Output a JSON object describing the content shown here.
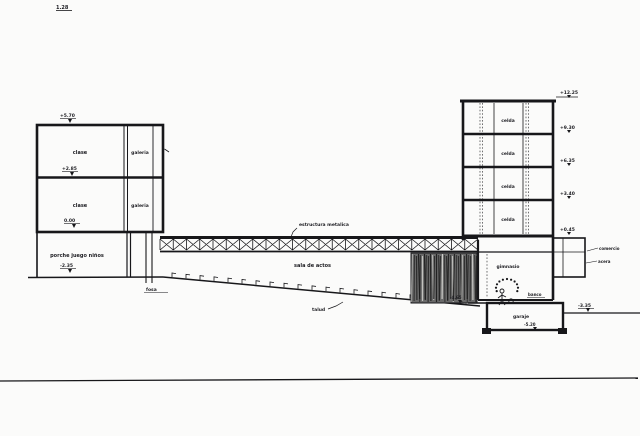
{
  "sheet": {
    "mark": "1.28"
  },
  "colors": {
    "ink": "#17171a",
    "paper": "#fbfbfa",
    "earth": "#6a6a6a"
  },
  "labels": {
    "left_building": {
      "floor1_room": "clase",
      "floor1_side": "galeria",
      "floor2_room": "clase",
      "floor2_side": "galeria",
      "level_roof": "+5.70",
      "level_floor1": "+2.85",
      "level_base": "0.00"
    },
    "porch": {
      "label": "porche juego niños",
      "level": "-2.35"
    },
    "bridge": {
      "structure_note": "estructura metalica",
      "hall": "sala de actos"
    },
    "slope": {
      "pit": "fosa",
      "slope_label": "talud"
    },
    "tower": {
      "floor_labels": [
        "celda",
        "celda",
        "celda",
        "celda"
      ],
      "levels": [
        "+12.25",
        "+9.30",
        "+6.35",
        "+3.40",
        "+0.45"
      ]
    },
    "gym": {
      "label": "gimnasio",
      "bench": "banco",
      "level": "-4.65"
    },
    "annex": {
      "shop": "comercio",
      "sidewalk": "acera"
    },
    "garage": {
      "label": "garaje",
      "level": "-5.20"
    },
    "street": {
      "level": "-3.35"
    }
  }
}
